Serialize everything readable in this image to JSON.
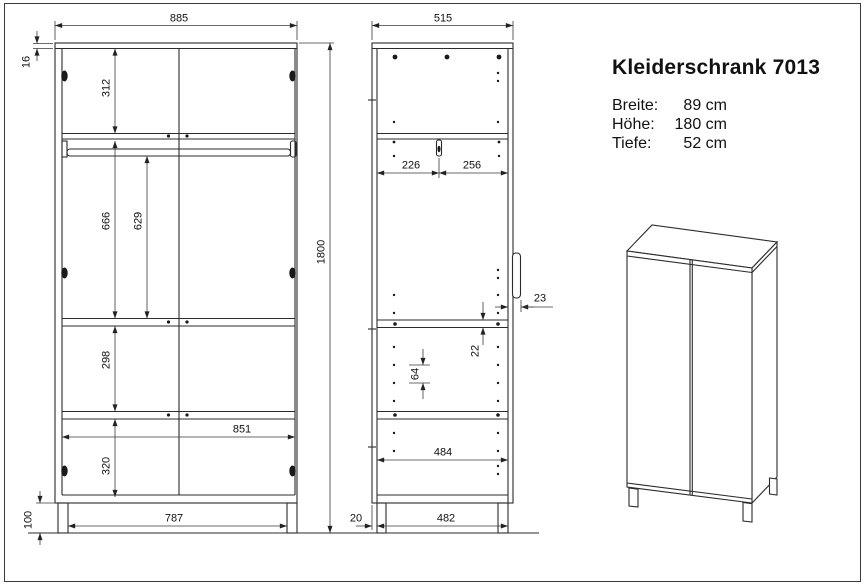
{
  "title_block": {
    "title": "Kleiderschrank 7013",
    "specs": [
      {
        "label": "Breite:",
        "value": "89 cm"
      },
      {
        "label": "Höhe:",
        "value": "180 cm"
      },
      {
        "label": "Tiefe:",
        "value": "52 cm"
      }
    ]
  },
  "front_view": {
    "dims": {
      "outer_width": "885",
      "top_panel_thickness": "16",
      "top_to_shelf": "312",
      "shelf_to_mid_shelf": "666",
      "rail_to_mid_shelf": "629",
      "total_height": "1800",
      "mid_to_lower_shelf": "298",
      "inner_width": "851",
      "lower_section": "320",
      "plinth_height": "100",
      "between_legs": "787"
    }
  },
  "side_view": {
    "dims": {
      "outer_depth": "515",
      "back_to_rail": "226",
      "rail_to_front": "256",
      "handle_offset": "23",
      "shelf_thickness": "22",
      "hole_pitch": "64",
      "inner_depth": "484",
      "back_leg_offset": "20",
      "leg_span": "482"
    }
  },
  "colors": {
    "line": "#2b2b2b",
    "dimension_line": "#333333",
    "text": "#111111",
    "background": "#ffffff"
  }
}
